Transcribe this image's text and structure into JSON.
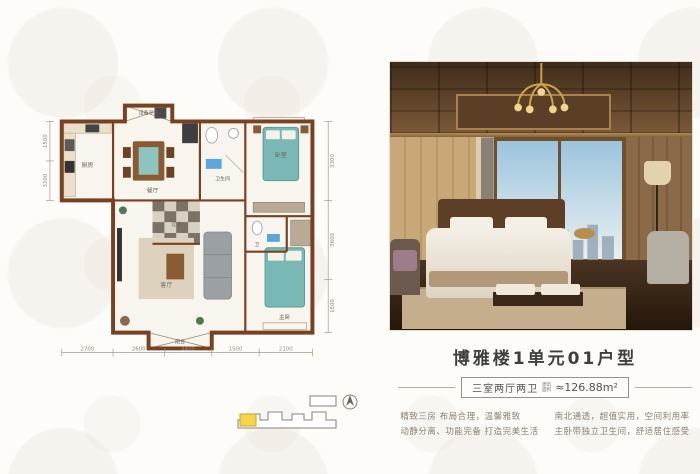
{
  "colors": {
    "wall_brown": "#7a4022",
    "bed_teal": "#79b8b4",
    "highlight_yellow": "#f6d54d",
    "title_gray": "#3f3f3f",
    "desc_gray": "#8a8075"
  },
  "floor_plan": {
    "rooms": [
      {
        "label": "厨房"
      },
      {
        "label": "餐厅"
      },
      {
        "label": "卫生间"
      },
      {
        "label": "卧室"
      },
      {
        "label": "过道"
      },
      {
        "label": "客厅"
      },
      {
        "label": "卫"
      },
      {
        "label": "主卧"
      },
      {
        "label": "阳台"
      },
      {
        "label": "设备平台"
      }
    ],
    "dims_bottom": [
      "2700",
      "2600",
      "4400",
      "1500",
      "2100"
    ],
    "dims_right": [
      "3300",
      "3600",
      "1500"
    ],
    "dims_left": [
      "1500",
      "3300"
    ]
  },
  "info": {
    "title": "博雅楼1单元01户型",
    "spec": "三室两厅两卫",
    "area_label_1": "建筑",
    "area_label_2": "面积",
    "area_value": "≈126.88m²",
    "desc_col1_line1": "精致三房 布局合理，温馨雅致",
    "desc_col1_line2": "动静分离、功能完备 打造完美生活",
    "desc_col2_line1": "南北通透，超值实用，空间利用率",
    "desc_col2_line2": "主卧带独立卫生间，舒适居住感受"
  }
}
